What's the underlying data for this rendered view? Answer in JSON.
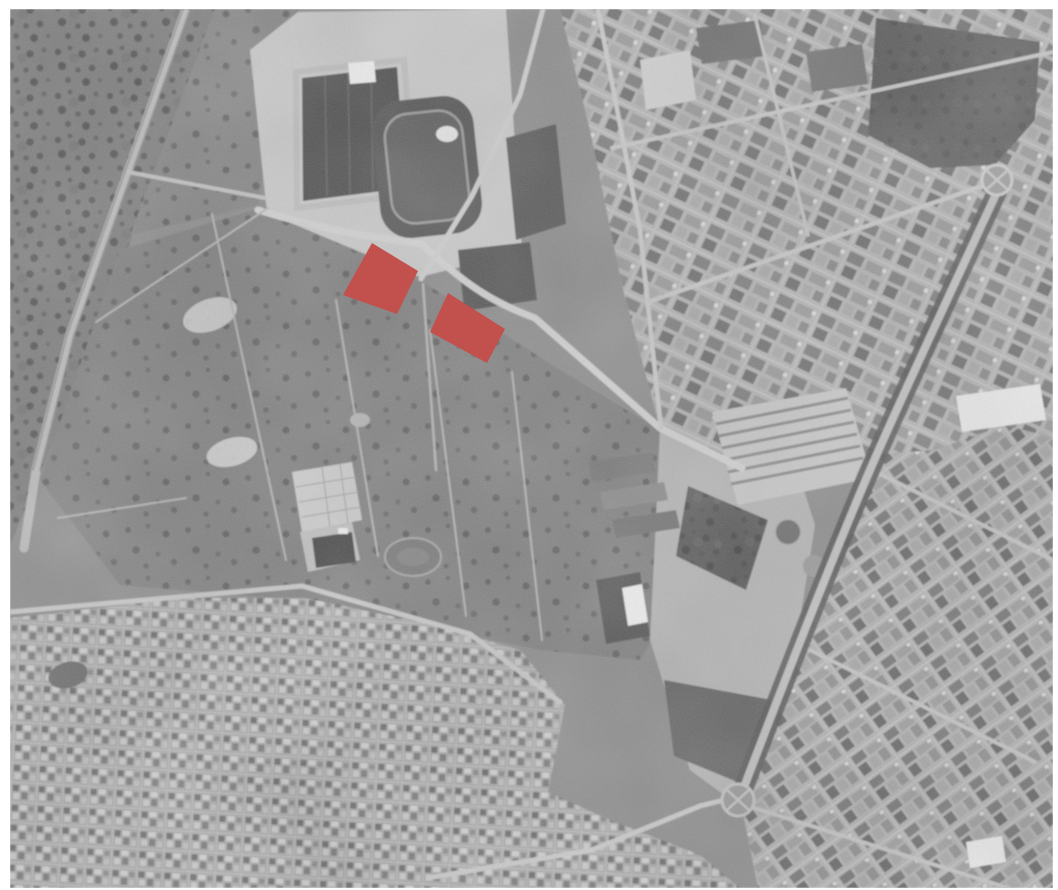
{
  "figure": {
    "kind": "grayscale-aerial-photograph",
    "alt": "Grayscale aerial photo of a town edge: football stadium and athletics track at top centre, orchard fields in the centre-left, a diagonal railway in the north-west, dense urban blocks on the right, low housing at the bottom-left. Two parcels south of the stadium are highlighted in red.",
    "width": 1058,
    "height": 890,
    "frame": {
      "x": 10,
      "y": 9,
      "width": 1043,
      "height": 879
    },
    "palette": {
      "paper": "#ffffff",
      "photo_base": "#8e8e8e",
      "photo_dark": "#4d4d4d",
      "photo_light": "#d2d2d2",
      "highlight": "#c2504c"
    },
    "features": [
      "railway-corridor-northwest",
      "scrubland-northwest",
      "orchard-fields-centre",
      "football-stadium",
      "athletics-track",
      "training-pitches",
      "northeast-city-blocks",
      "southeast-city-blocks",
      "southwest-housing",
      "park-grove-northeast",
      "tree-lined-avenue",
      "north-roundabout",
      "south-roundabout",
      "parking-lot",
      "farm-greenhouses",
      "institutional-campus"
    ]
  },
  "highlights": {
    "color": "#c2504c",
    "parcels": [
      {
        "name": "highlight-parcel-west",
        "points": "372,243 418,271 397,314 343,295"
      },
      {
        "name": "highlight-parcel-east",
        "points": "448,293 505,329 487,363 430,332"
      }
    ]
  }
}
